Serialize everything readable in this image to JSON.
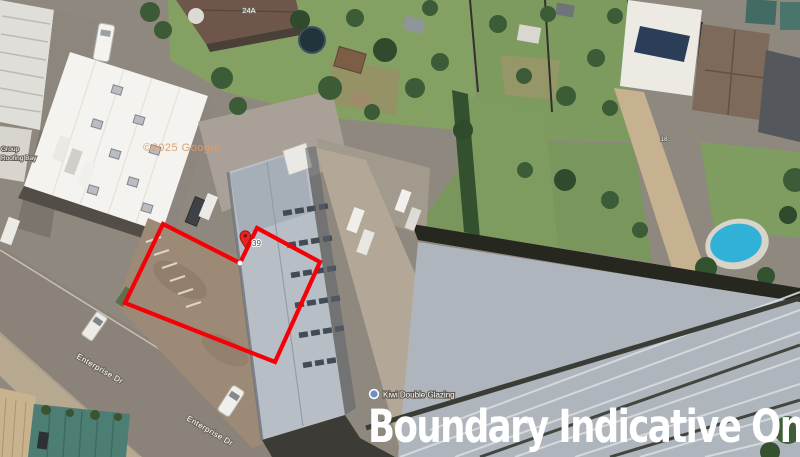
{
  "map": {
    "caption": "Boundary Indicative Only",
    "watermark": "©2025 Google",
    "street_labels": [
      {
        "text": "Enterprise Dr"
      },
      {
        "text": "Enterprise Dr"
      }
    ],
    "poi": {
      "name": "Kiwi Double Glazing"
    },
    "pin": {
      "label": "39"
    },
    "house_numbers": [
      {
        "text": "24A"
      },
      {
        "text": "18"
      }
    ],
    "roof_business_label": {
      "line1": "Group",
      "line2": "Roofing Bay"
    },
    "colors": {
      "boundary_red": "#f50008",
      "pin_red": "#e8261f",
      "caption_white": "#ffffff",
      "watermark_orange": "#e09d66",
      "poi_icon_blue": "#6b8fc9"
    }
  }
}
